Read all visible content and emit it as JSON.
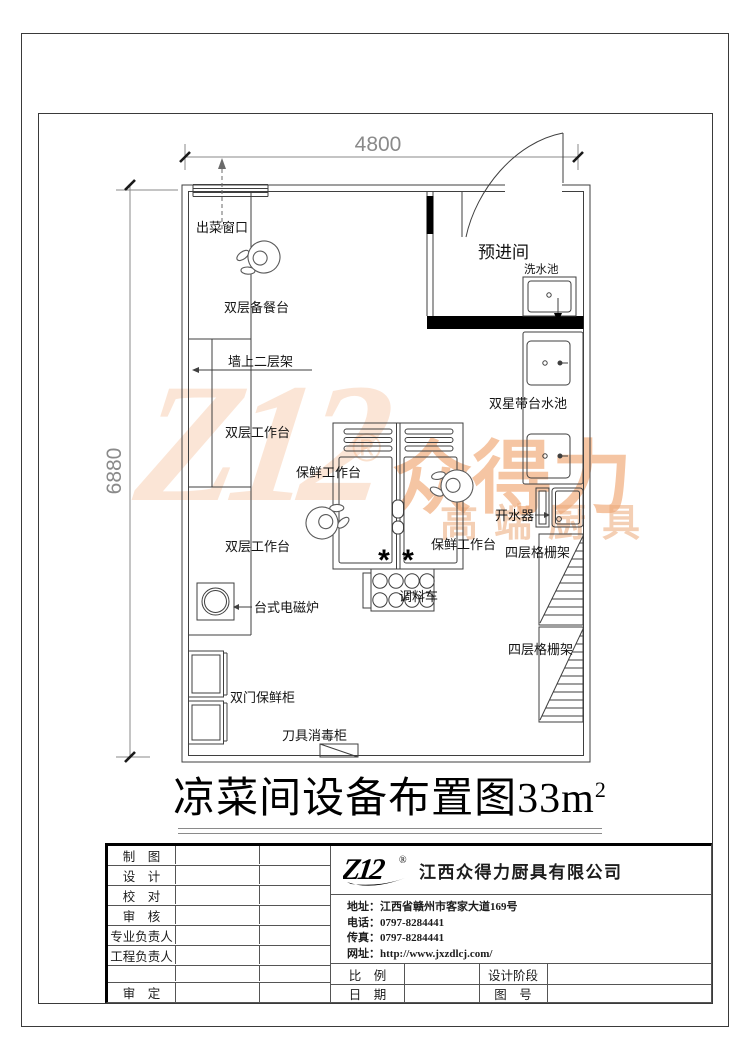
{
  "plan": {
    "dims": {
      "width": "4800",
      "height": "6880"
    },
    "room": {
      "pre_entry": "预进间"
    },
    "labels": {
      "serving_window": "出菜窗口",
      "prep_counter": "双层备餐台",
      "wall_shelf": "墙上二层架",
      "work_table": "双层工作台",
      "fresh_worktable": "保鲜工作台",
      "star_sink": "双星带台水池",
      "wash_sink": "洗水池",
      "boiler": "开水器",
      "grid_shelf": "四层格栅架",
      "induction": "台式电磁炉",
      "spice_cart": "调料车",
      "fridge": "双门保鲜柜",
      "knife_cabinet": "刀具消毒柜",
      "star": "*"
    }
  },
  "title": {
    "text": "凉菜间设备布置图33m",
    "sup": "2"
  },
  "title_block": {
    "rows": [
      "制　图",
      "设　计",
      "校　对",
      "审　核",
      "专业负责人",
      "工程负责人",
      "",
      "审　定"
    ],
    "logo_text": "Z12",
    "logo_reg": "®",
    "company": "江西众得力厨具有限公司",
    "contact": [
      {
        "k": "地址：",
        "v": "江西省赣州市客家大道169号"
      },
      {
        "k": "电话：",
        "v": "0797-8284441"
      },
      {
        "k": "传真：",
        "v": "0797-8284441"
      },
      {
        "k": "网址：",
        "v": "http://www.jxzdlcj.com/"
      }
    ],
    "fields": {
      "scale": "比　例",
      "stage": "设计阶段",
      "date": "日　期",
      "no": "图　号"
    }
  },
  "watermark": {
    "mark": "Z12",
    "reg": "®",
    "brand": "众得力",
    "tagline": "高端厨具",
    "brand_color": "#EC8C49",
    "light_color": "#F2A56E"
  }
}
